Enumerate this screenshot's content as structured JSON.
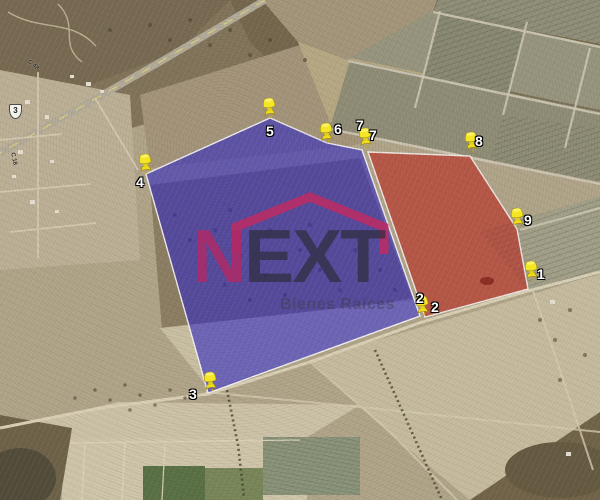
{
  "watermark": {
    "brand_first": "N",
    "brand_rest": "EXT",
    "tagline": "Bienes Raíces",
    "brand_first_color": "#ac2a68",
    "brand_rest_color": "#2c2c3a",
    "roof_color": "#c22960"
  },
  "road_shield": {
    "number": "3"
  },
  "road_labels": [
    {
      "text": "C 48"
    },
    {
      "text": "C 18"
    }
  ],
  "placemarks": [
    {
      "num": "1",
      "pin": {
        "x": 532,
        "y": 282
      },
      "labels": [
        {
          "x": 537,
          "y": 267
        }
      ]
    },
    {
      "num": "2",
      "pin": {
        "x": 423,
        "y": 317
      },
      "labels": [
        {
          "x": 416,
          "y": 291
        },
        {
          "x": 431,
          "y": 300
        }
      ]
    },
    {
      "num": "3",
      "pin": {
        "x": 211,
        "y": 393
      },
      "labels": [
        {
          "x": 189,
          "y": 387
        }
      ]
    },
    {
      "num": "4",
      "pin": {
        "x": 146,
        "y": 175
      },
      "labels": [
        {
          "x": 136,
          "y": 175
        }
      ]
    },
    {
      "num": "5",
      "pin": {
        "x": 270,
        "y": 119
      },
      "labels": [
        {
          "x": 266,
          "y": 124
        }
      ]
    },
    {
      "num": "6",
      "pin": {
        "x": 327,
        "y": 144
      },
      "labels": [
        {
          "x": 334,
          "y": 122
        }
      ]
    },
    {
      "num": "7",
      "pin": {
        "x": 366,
        "y": 149
      },
      "labels": [
        {
          "x": 356,
          "y": 118
        },
        {
          "x": 369,
          "y": 128
        }
      ]
    },
    {
      "num": "8",
      "pin": {
        "x": 472,
        "y": 153
      },
      "labels": [
        {
          "x": 475,
          "y": 134
        }
      ]
    },
    {
      "num": "9",
      "pin": {
        "x": 518,
        "y": 229
      },
      "labels": [
        {
          "x": 524,
          "y": 213
        }
      ]
    }
  ],
  "parcels": [
    {
      "name": "blue",
      "fill": "rgba(45,36,198,0.58)",
      "stroke": "rgba(252,252,252,0.88)",
      "points": [
        [
          146,
          174
        ],
        [
          270,
          118
        ],
        [
          327,
          143
        ],
        [
          362,
          150
        ],
        [
          420,
          316
        ],
        [
          208,
          393
        ]
      ]
    },
    {
      "name": "red",
      "fill": "rgba(187,36,27,0.60)",
      "stroke": "rgba(252,252,252,0.82)",
      "points": [
        [
          368,
          152
        ],
        [
          470,
          156
        ],
        [
          517,
          229
        ],
        [
          528,
          289
        ],
        [
          425,
          317
        ]
      ]
    }
  ],
  "pin_color": "#f2e12b"
}
